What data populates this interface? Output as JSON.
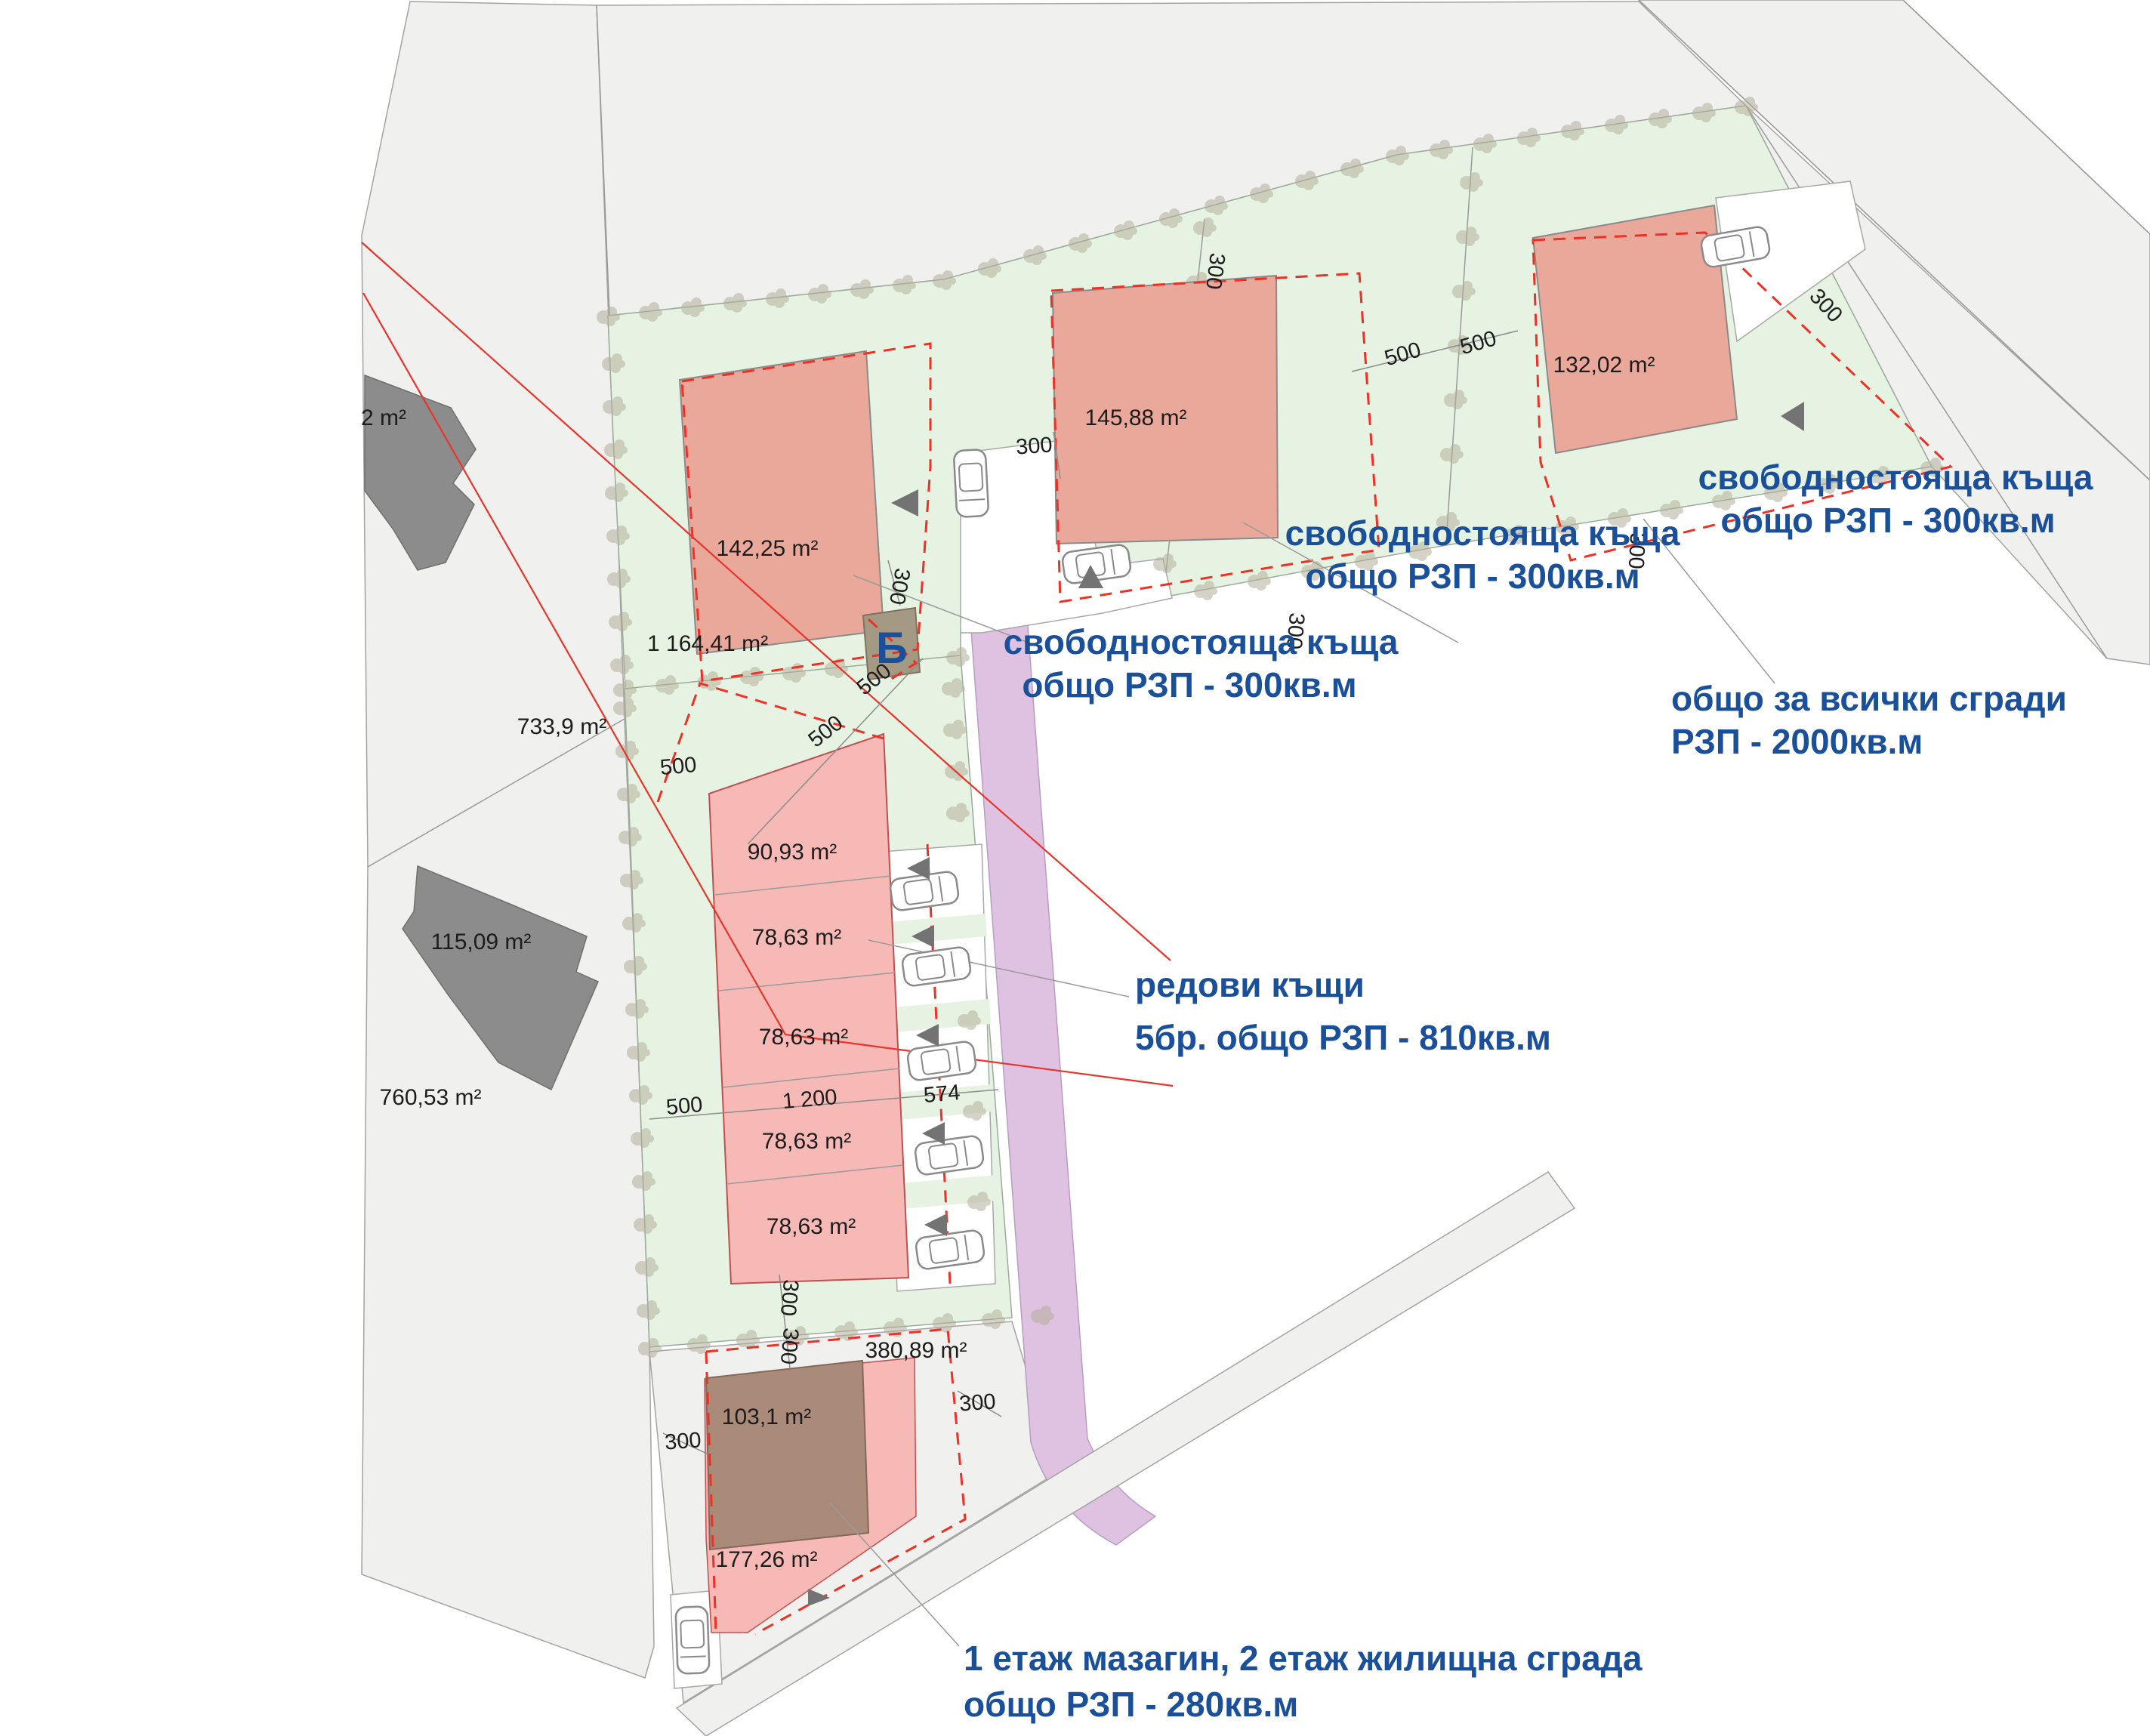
{
  "labels": {
    "a142": "142,25 m²",
    "a145": "145,88 m²",
    "a132": "132,02 m²",
    "a1164": "1 164,41 m²",
    "a733": "733,9 m²",
    "a2": "2 m²",
    "a115": "115,09 m²",
    "a760": "760,53 m²",
    "a90": "90,93 m²",
    "a78": "78,63 m²",
    "a380": "380,89 m²",
    "a103": "103,1 m²",
    "a177": "177,26 m²",
    "d300": "300",
    "d500": "500",
    "d1200": "1 200",
    "d574": "574",
    "marker_b": "Б"
  },
  "annotations": {
    "detached_tr": {
      "l1": "свободностояща къща",
      "l2": "общо РЗП - 300кв.м"
    },
    "detached_mid": {
      "l1": "свободностояща къща",
      "l2": "общо РЗП - 300кв.м"
    },
    "detached_low": {
      "l1": "свободностояща къща",
      "l2": "общо РЗП - 300кв.м"
    },
    "total": {
      "l1": "общо за всички сгради",
      "l2": "РЗП - 2000кв.м"
    },
    "rows": {
      "l1": "редови къщи",
      "l2": "5бр. общо РЗП - 810кв.м"
    },
    "mixed": {
      "l1": "1 етаж мазагин, 2 етаж жилищна сграда",
      "l2": "общо РЗП - 280кв.м"
    }
  },
  "colors": {
    "annotation_blue": "#1a4f9a",
    "parcel_green": "#e7f3e2",
    "neighbor_gray": "#f0f0ee",
    "road_purple": "#dfc2e2",
    "building_pink": "#eaa89b",
    "rowhouse_pink": "#f6b9b6",
    "building_brown": "#aa8a78",
    "building_dark_gray": "#8c8c8c",
    "marker_building_olive": "#a49a84",
    "red_line": "#e8342a"
  }
}
